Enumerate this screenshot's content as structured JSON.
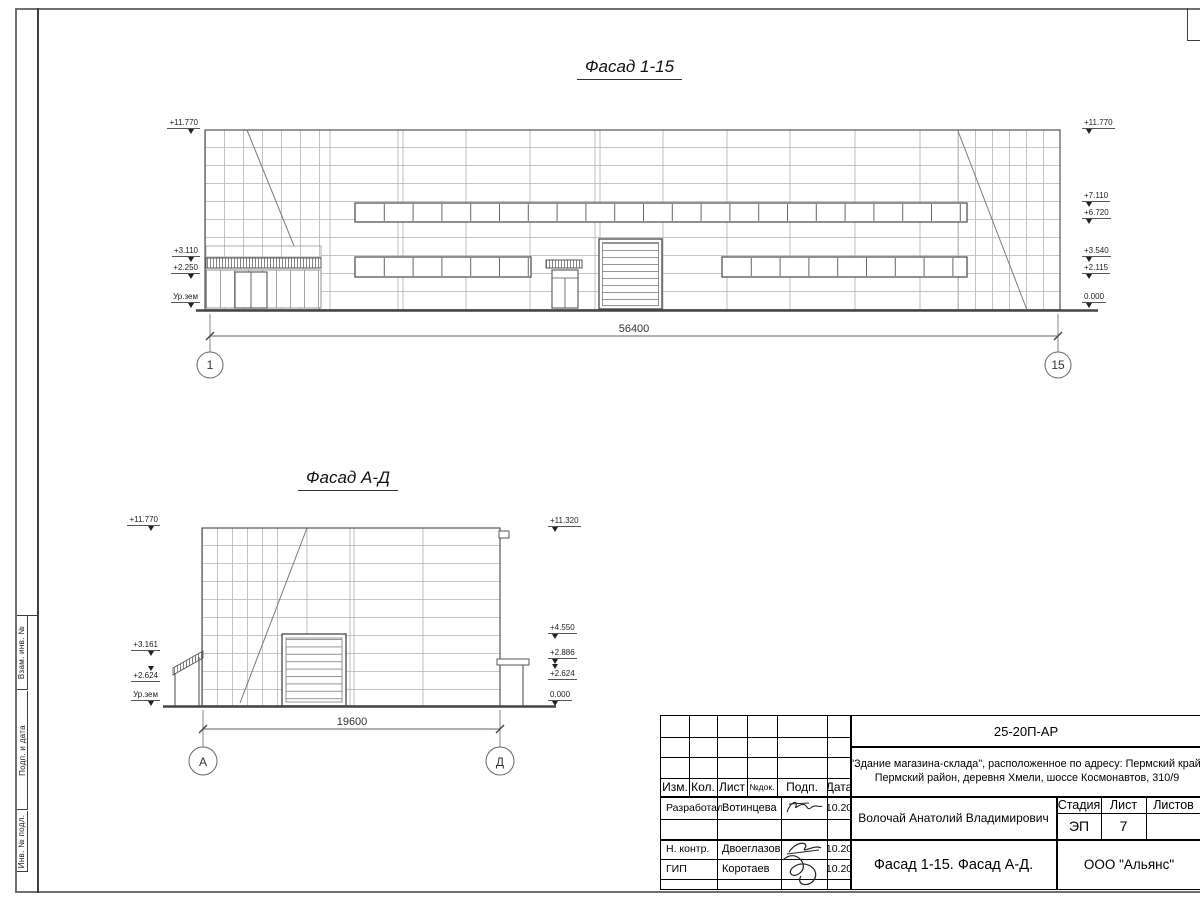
{
  "facade1": {
    "title": "Фасад 1-15",
    "dimension": "56400",
    "axis_left": "1",
    "axis_right": "15",
    "marks_left": [
      "+11.770",
      "+3.110",
      "+2.250",
      "Ур.зем"
    ],
    "marks_right": [
      "+11.770",
      "+7.110",
      "+6.720",
      "+3.540",
      "+2.115",
      "0.000"
    ]
  },
  "facade2": {
    "title": "Фасад А-Д",
    "dimension": "19600",
    "axis_left": "А",
    "axis_right": "Д",
    "marks_left": [
      "+11.770",
      "+3.161",
      "+2.624",
      "Ур.зем"
    ],
    "marks_right": [
      "+11.320",
      "+4.550",
      "+2.886",
      "+2.624",
      "0.000"
    ]
  },
  "side_stamp": {
    "labels": [
      "Взам. инв. №",
      "Подп. и дата",
      "Инв. № подл."
    ]
  },
  "title_block": {
    "doc_number": "25-20П-АР",
    "project_line1": "\"Здание магазина-склада\", расположенное по адресу: Пермский край,",
    "project_line2": "Пермский район, деревня Хмели, шоссе Космонавтов, 310/9",
    "header_cols": [
      "Изм.",
      "Кол.",
      "Лист",
      "№док.",
      "Подп.",
      "Дата"
    ],
    "rows": [
      {
        "role": "Разработал",
        "name": "Вотинцева",
        "date": "10.20"
      },
      {
        "role": "Н. контр.",
        "name": "Двоеглазов",
        "date": "10.20"
      },
      {
        "role": "ГИП",
        "name": "Коротаев",
        "date": "10.20"
      }
    ],
    "chief_name": "Волочай Анатолий Владимирович",
    "stage_label": "Стадия",
    "sheet_label": "Лист",
    "sheets_label": "Листов",
    "stage_value": "ЭП",
    "sheet_value": "7",
    "sheets_value": "",
    "sheet_title": "Фасад 1-15. Фасад А-Д.",
    "company": "ООО \"Альянс\""
  }
}
